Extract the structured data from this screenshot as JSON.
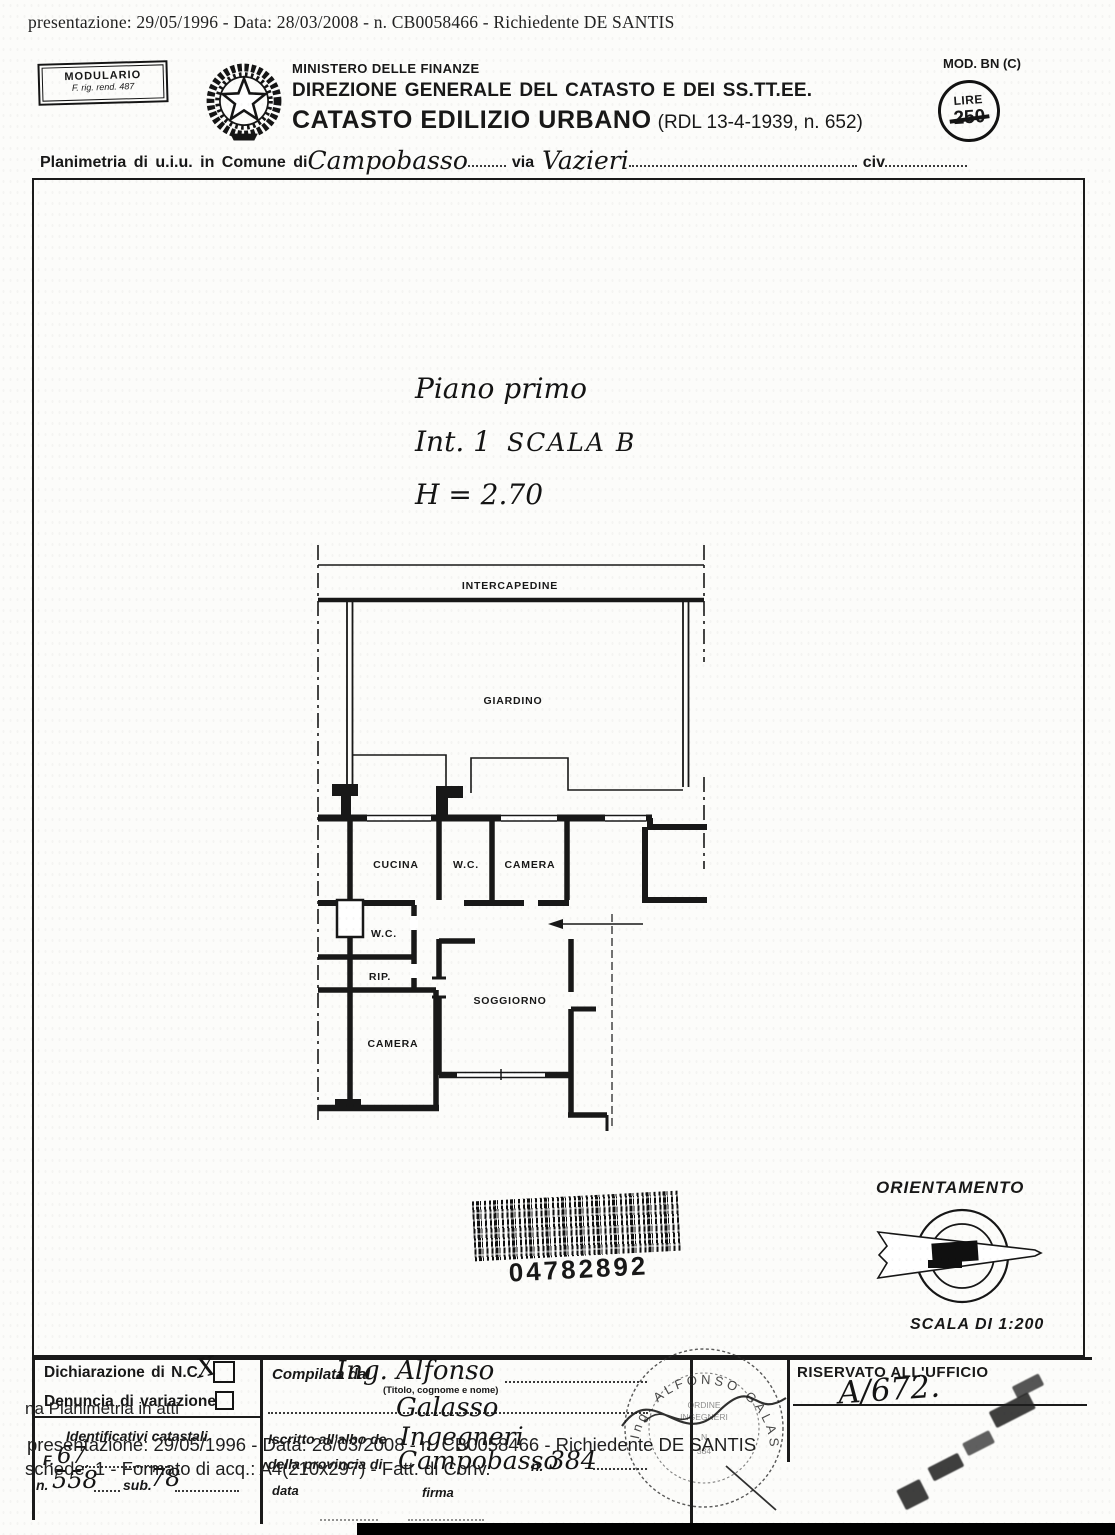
{
  "overlay": {
    "top": "presentazione: 29/05/1996 - Data: 28/03/2008 -  n. CB0058466 - Richiedente DE SANTIS",
    "bottom1": "na Planimetria in atti",
    "bottom2": "presentazione: 29/05/1996 - Data: 28/03/2008 - n. CB0058466 - Richiedente DE SANTIS",
    "bottom3": "schede: 1 - Formato di acq.: A4(210x297) - Fatt. di Conv."
  },
  "header": {
    "modulario_line1": "MODULARIO",
    "modulario_line2": "F. rig. rend. 487",
    "ministero": "MINISTERO DELLE FINANZE",
    "direzione": "DIREZIONE GENERALE DEL CATASTO E DEI SS.TT.EE.",
    "catasto": "CATASTO EDILIZIO URBANO",
    "catasto_ref": "(RDL 13-4-1939, n. 652)",
    "mod_label": "MOD. BN (C)",
    "lire_label": "LIRE",
    "lire_value": "250"
  },
  "intestazione": {
    "planimetria_label": "Planimetria di u.i.u. in Comune di",
    "comune": "Campobasso",
    "via_label": "via",
    "via": "Vazieri",
    "civ_label": "civ"
  },
  "plan": {
    "title_line1": "Piano primo",
    "title_line2a": "Int. 1",
    "title_line2b": "SCALA B",
    "title_line3": "H = 2.70",
    "rooms": {
      "intercapedine": "INTERCAPEDINE",
      "giardino": "GIARDINO",
      "cucina": "CUCINA",
      "wc_top": "W.C.",
      "camera_top": "CAMERA",
      "wc_mid": "W.C.",
      "rip": "RIP.",
      "soggiorno": "SOGGIORNO",
      "camera_bottom": "CAMERA"
    }
  },
  "barcode": {
    "number": "04782892"
  },
  "orientamento": {
    "title": "ORIENTAMENTO",
    "scala": "SCALA DI 1:200"
  },
  "form": {
    "dichiarazione": "Dichiarazione di N.C.",
    "denuncia": "Denuncia di variazione",
    "identificativi": "Identificativi catastali",
    "f_label": "F.",
    "f_value": "67",
    "n_label": "n.",
    "n_value": "558",
    "sub_label": "sub.",
    "sub_value": "78",
    "checkbox_mark": "X",
    "compilata_label": "Compilata dal",
    "compilata_name1": "Ing.  Alfonso",
    "compilata_note": "(Titolo, cognome e nome)",
    "compilata_name2": "Galasso",
    "iscritto_label": "Iscritto all'albo de",
    "iscritto_value": "Ingegneri",
    "provincia_label": "della provincia di",
    "provincia_value": "Campobasso",
    "albo_n_label": "n.",
    "albo_n_value": "384",
    "data_label": "data",
    "firma_label": "firma",
    "riservato_label": "RISERVATO ALL'UFFICIO",
    "protocollo": "A/672."
  },
  "stamp": {
    "ring": "Ing. ALFONSO GALASSO",
    "center_line1": "ORDINE",
    "center_line2": "INGEGNERI",
    "center_line3": "N",
    "center_line4": "384"
  }
}
